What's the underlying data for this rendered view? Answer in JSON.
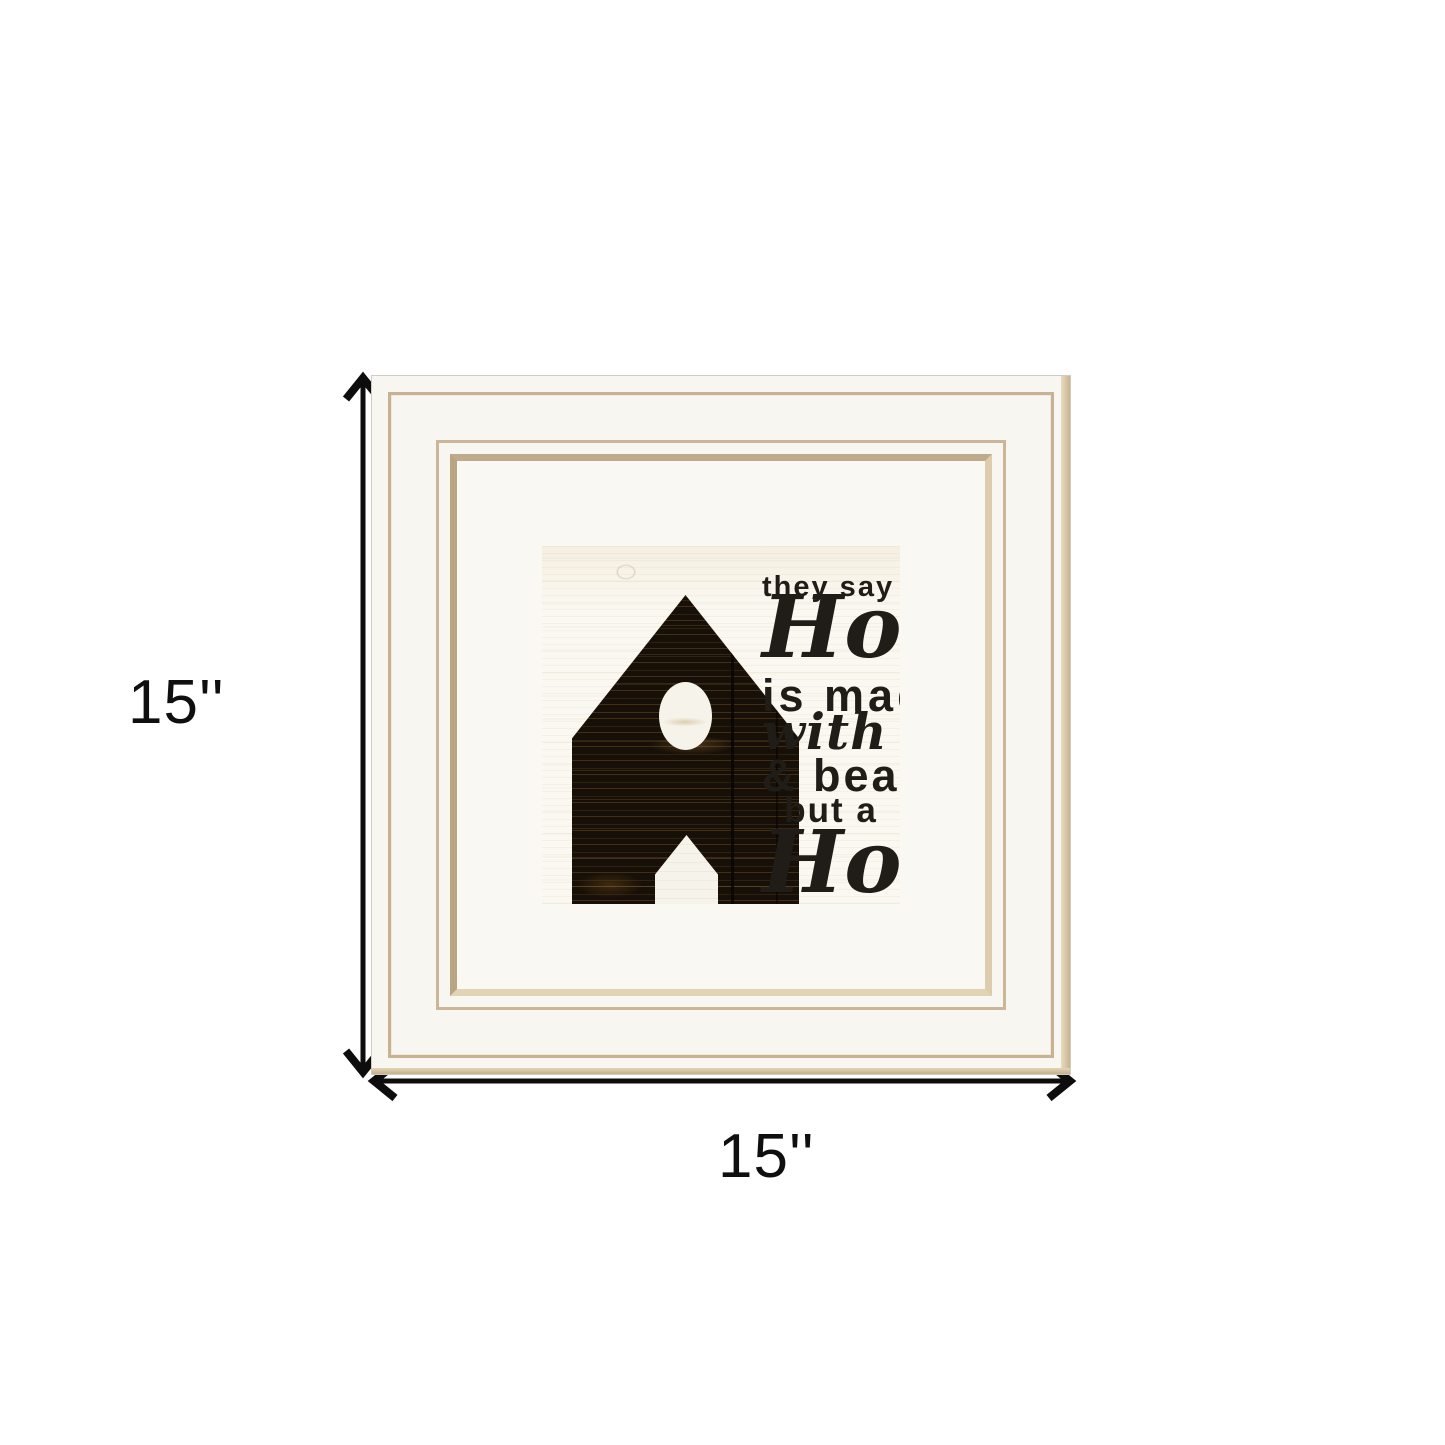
{
  "product_view": {
    "dimension_height_label": "15''",
    "dimension_width_label": "15''"
  },
  "artwork": {
    "lines": [
      {
        "text": "they say a"
      },
      {
        "text": "House"
      },
      {
        "text": "is made"
      },
      {
        "text": "with walls"
      },
      {
        "text": "& beams"
      },
      {
        "text": "but a"
      },
      {
        "text": "Home"
      },
      {
        "text": "is made"
      },
      {
        "text": "with love"
      },
      {
        "text": "& dreams"
      }
    ],
    "signature": "©Cindy Jacobs"
  },
  "colors": {
    "page_background": "#ffffff",
    "frame_white": "#f8f6f0",
    "frame_trim_tan": "#c8b293",
    "frame_side_shadow": "#d2bd9d",
    "mat_white": "#faf8f2",
    "art_background": "#fbf8f1",
    "house_wood_dark": "#171008",
    "ink": "#201c17",
    "dimension_annotation": "#0f0f0f"
  }
}
